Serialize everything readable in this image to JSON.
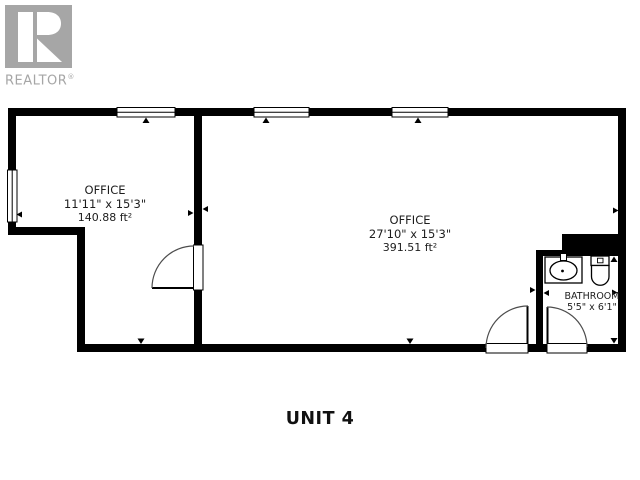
{
  "logo": {
    "brand": "REALTOR",
    "registered_mark": "®",
    "color": "#a6a6a6",
    "icon": "realtor-block-r"
  },
  "plan": {
    "unit_label": "UNIT 4",
    "rooms": [
      {
        "name": "OFFICE",
        "dimensions": "11'11\" x 15'3\"",
        "area": "140.88 ft²"
      },
      {
        "name": "OFFICE",
        "dimensions": "27'10\" x 15'3\"",
        "area": "391.51 ft²"
      },
      {
        "name": "BATHROOM",
        "dimensions": "5'5\" x 6'1\""
      }
    ],
    "fixtures": [
      "sink",
      "toilet"
    ],
    "icons": [
      "window-icon",
      "door-swing-icon",
      "dimension-arrow-icon"
    ]
  },
  "colors": {
    "wall": "#000000",
    "floor": "#ffffff",
    "text": "#1d1d1d",
    "door_arc": "#4d4d4d"
  }
}
